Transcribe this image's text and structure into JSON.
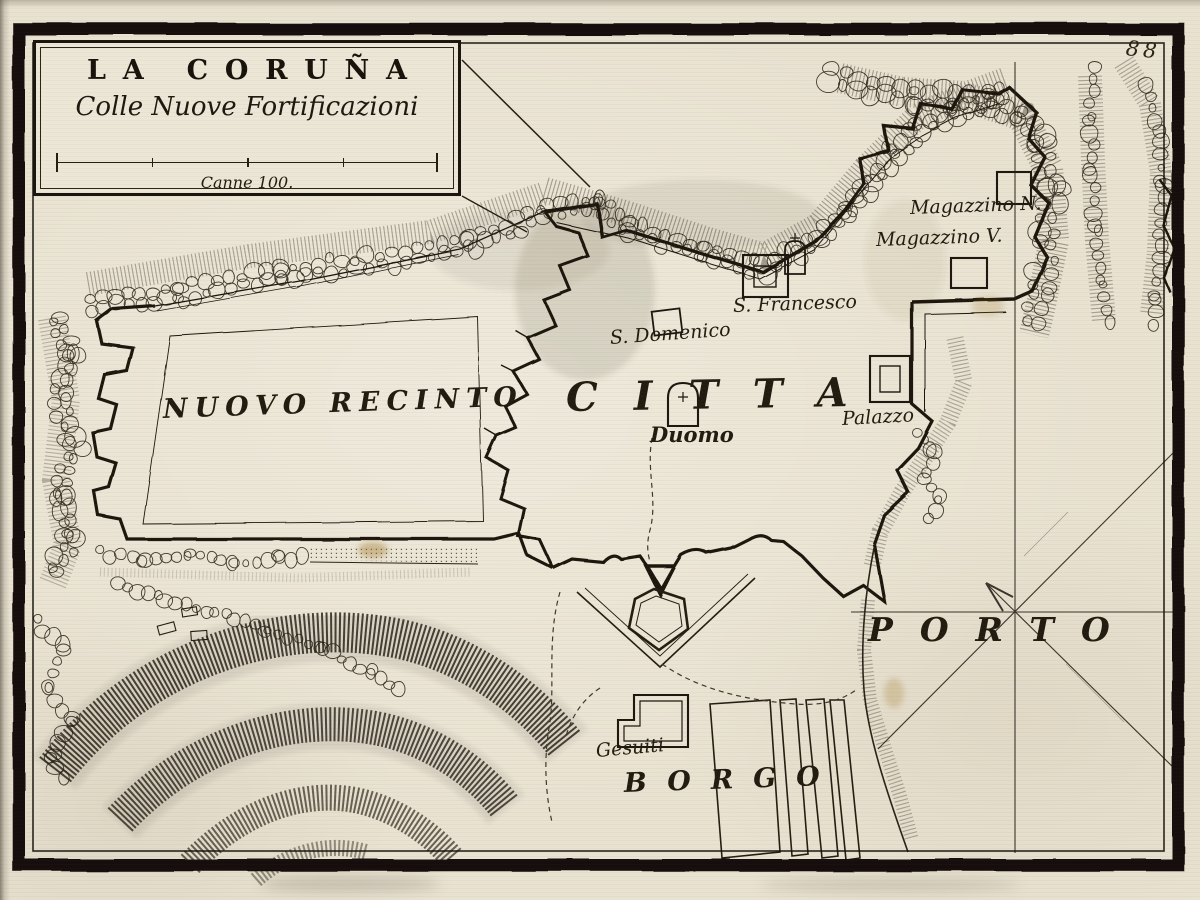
{
  "page": {
    "number": "88"
  },
  "cartouche": {
    "title": "LA CORUÑA",
    "subtitle": "Colle Nuove Fortificazioni",
    "scale_label": "Canne 100."
  },
  "labels": {
    "nuovo_recinto": "NUOVO RECINTO",
    "citta": "CITTA",
    "duomo": "Duomo",
    "palazzo": "Palazzo",
    "s_domenico": "S. Domenico",
    "s_francesco": "S. Francesco",
    "magazzino_n": "Magazzino N.",
    "magazzino_v": "Magazzino V.",
    "porto": "PORTO",
    "borgo": "BORGO",
    "gesuiti": "Gesuiti"
  },
  "icons": {
    "north_arrow": "compass-north-arrow"
  },
  "colors": {
    "paper": "#e9e2d1",
    "ink": "#1d1710",
    "shade": "#352d21"
  }
}
